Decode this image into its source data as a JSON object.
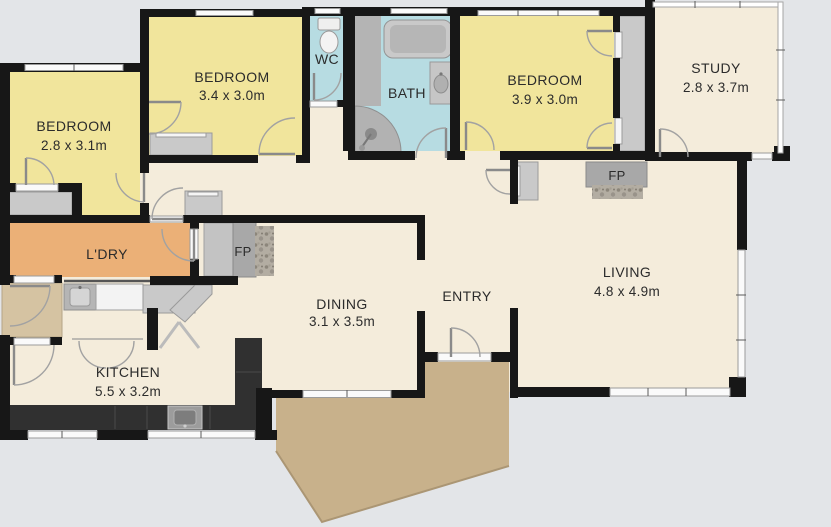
{
  "title": "Residential floor plan",
  "colors": {
    "background": "#e3e5e8",
    "floor": "#f4ecdb",
    "bedroom": "#f1e59c",
    "wet_area": "#b7dce2",
    "laundry": "#ebb077",
    "porch": "#d5c3a2",
    "deck": "#c8b18b",
    "wall": "#171717",
    "counter_dark": "#303030",
    "cabinet_gray": "#c9c9c9"
  },
  "rooms": [
    {
      "id": "bedroom-left",
      "name": "BEDROOM",
      "dims": "2.8 x 3.1m"
    },
    {
      "id": "bedroom-mid",
      "name": "BEDROOM",
      "dims": "3.4 x 3.0m"
    },
    {
      "id": "wc",
      "name": "WC",
      "dims": ""
    },
    {
      "id": "bath",
      "name": "BATH",
      "dims": ""
    },
    {
      "id": "bedroom-right",
      "name": "BEDROOM",
      "dims": "3.9 x 3.0m"
    },
    {
      "id": "study",
      "name": "STUDY",
      "dims": "2.8 x 3.7m"
    },
    {
      "id": "living",
      "name": "LIVING",
      "dims": "4.8 x 4.9m"
    },
    {
      "id": "entry",
      "name": "ENTRY",
      "dims": ""
    },
    {
      "id": "dining",
      "name": "DINING",
      "dims": "3.1 x 3.5m"
    },
    {
      "id": "laundry",
      "name": "L'DRY",
      "dims": ""
    },
    {
      "id": "kitchen",
      "name": "KITCHEN",
      "dims": "5.5 x 3.2m"
    }
  ],
  "fireplaces": {
    "dining": "FP",
    "living": "FP"
  }
}
